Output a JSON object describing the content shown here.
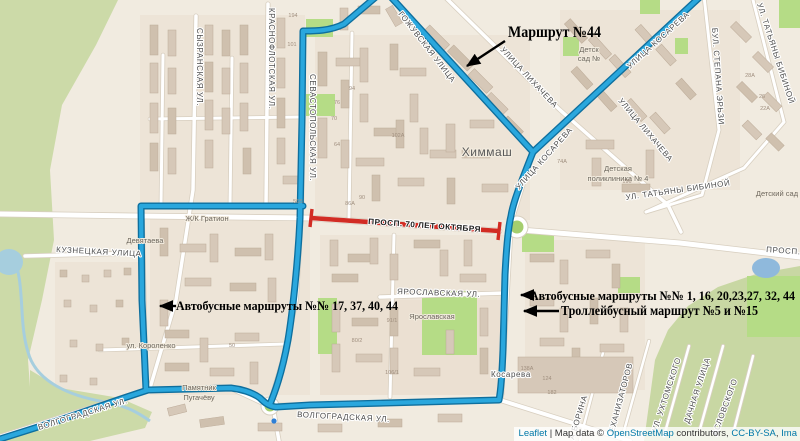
{
  "annotations": {
    "route44": "Маршрут №44",
    "left_bus": "Автобусные маршруты №№ 17, 37, 40, 44",
    "right_bus": "Автобусные маршруты №№ 1, 16, 20,23,27, 32, 44",
    "trolleybus": "Троллейбусный маршрут №5 и №15"
  },
  "closed_road": {
    "label": "ПРОСП. 70 ЛЕТ ОКТЯБРЯ"
  },
  "attribution": {
    "leaflet": "Leaflet",
    "sep1": " | Map data © ",
    "osm": "OpenStreetMap",
    "sep2": " contributors, ",
    "license": "CC-BY-SA",
    "sep3": ", ",
    "imagery": "Ima"
  },
  "map": {
    "street_labels": [
      {
        "t": "СЫЗРАНСКАЯ УЛ.",
        "x": 197,
        "y": 28,
        "r": 90
      },
      {
        "t": "КРАСНОФЛОТСКАЯ УЛ.",
        "x": 269,
        "y": 8,
        "r": 90
      },
      {
        "t": "СЕВАСТОПОЛЬСКАЯ УЛ.",
        "x": 310,
        "y": 74,
        "r": 90
      },
      {
        "t": "ГОЖУВСКАЯ УЛИЦА",
        "x": 398,
        "y": 14,
        "r": 52
      },
      {
        "t": "УЛИЦА ЛИХАЧЕВА",
        "x": 500,
        "y": 50,
        "r": 47
      },
      {
        "t": "УЛИЦА ЛИХАЧЕВА",
        "x": 618,
        "y": 101,
        "r": 50
      },
      {
        "t": "УЛИЦА КОСАРЕВА",
        "x": 630,
        "y": 69,
        "r": -42
      },
      {
        "t": "УЛИЦА КОСАРЕВА",
        "x": 519,
        "y": 190,
        "r": -48
      },
      {
        "t": "УЛ. ТАТЬЯНЫ БИБИНОЙ",
        "x": 757,
        "y": 4,
        "r": 72
      },
      {
        "t": "БУЛ. СТЕПАНА ЭРЬЗИ",
        "x": 712,
        "y": 28,
        "r": 86
      },
      {
        "t": "УЛ. ТАТЬЯНЫ БИБИНОЙ",
        "x": 626,
        "y": 200,
        "r": -8
      },
      {
        "t": "КУЗНЕЦКАЯ УЛИЦА",
        "x": 56,
        "y": 252,
        "r": 3
      },
      {
        "t": "ЯРОСЛАВСКАЯ УЛ.",
        "x": 397,
        "y": 294,
        "r": 2
      },
      {
        "t": "ВОЛГОГРАДСКАЯ УЛ.",
        "x": 39,
        "y": 430,
        "r": -17
      },
      {
        "t": "ВОЛГОГРАДСКАЯ УЛ.",
        "x": 297,
        "y": 417,
        "r": 3
      },
      {
        "t": "ПРОСП. 7",
        "x": 766,
        "y": 252,
        "r": 4
      },
      {
        "t": "Косарева",
        "x": 491,
        "y": 377,
        "r": 0
      },
      {
        "t": "А БОРИНА",
        "x": 574,
        "y": 440,
        "r": -73
      },
      {
        "t": "ЕХАНИЗАТОРОВ",
        "x": 614,
        "y": 433,
        "r": -75
      },
      {
        "t": "УЛ. УХТОМСКОГО",
        "x": 657,
        "y": 432,
        "r": -72
      },
      {
        "t": "ДАЧНАЯ УЛИЦА",
        "x": 689,
        "y": 424,
        "r": -72
      },
      {
        "t": "АСЛОВСКОГО",
        "x": 717,
        "y": 436,
        "r": -70
      }
    ],
    "place_labels": [
      {
        "t": "Химмаш",
        "x": 487,
        "y": 156,
        "a": "middle",
        "c": "big"
      },
      {
        "t": "Детская",
        "x": 618,
        "y": 171,
        "a": "middle"
      },
      {
        "t": "поликлиника № 4",
        "x": 618,
        "y": 181,
        "a": "middle"
      },
      {
        "t": "Детск",
        "x": 589,
        "y": 52,
        "a": "middle"
      },
      {
        "t": "сад №",
        "x": 589,
        "y": 61,
        "a": "middle"
      },
      {
        "t": "Детский сад",
        "x": 777,
        "y": 196,
        "a": "middle"
      },
      {
        "t": "Ж/К Гратион",
        "x": 207,
        "y": 221,
        "a": "middle"
      },
      {
        "t": "Девятаева",
        "x": 145,
        "y": 243,
        "a": "middle"
      },
      {
        "t": "ул. Короленко",
        "x": 151,
        "y": 348,
        "a": "middle"
      },
      {
        "t": "Памятник",
        "x": 199,
        "y": 390,
        "a": "middle"
      },
      {
        "t": "Пугачёву",
        "x": 199,
        "y": 400,
        "a": "middle"
      },
      {
        "t": "Ярославская",
        "x": 432,
        "y": 319,
        "a": "middle"
      }
    ],
    "house_numbers": [
      {
        "t": "194",
        "x": 293,
        "y": 17
      },
      {
        "t": "101",
        "x": 292,
        "y": 46
      },
      {
        "t": "94",
        "x": 352,
        "y": 90
      },
      {
        "t": "76",
        "x": 337,
        "y": 104
      },
      {
        "t": "70",
        "x": 334,
        "y": 120
      },
      {
        "t": "64",
        "x": 337,
        "y": 146
      },
      {
        "t": "102А",
        "x": 398,
        "y": 137
      },
      {
        "t": "86А",
        "x": 350,
        "y": 205
      },
      {
        "t": "56Б",
        "x": 298,
        "y": 203
      },
      {
        "t": "90",
        "x": 362,
        "y": 199
      },
      {
        "t": "74А",
        "x": 562,
        "y": 163
      },
      {
        "t": "196",
        "x": 627,
        "y": 183
      },
      {
        "t": "28А",
        "x": 750,
        "y": 77
      },
      {
        "t": "26",
        "x": 762,
        "y": 98
      },
      {
        "t": "22А",
        "x": 765,
        "y": 110
      },
      {
        "t": "91/1",
        "x": 392,
        "y": 322
      },
      {
        "t": "80/2",
        "x": 357,
        "y": 342
      },
      {
        "t": "106/1",
        "x": 392,
        "y": 374
      },
      {
        "t": "138А",
        "x": 527,
        "y": 370
      },
      {
        "t": "124",
        "x": 547,
        "y": 380
      },
      {
        "t": "182",
        "x": 552,
        "y": 394
      },
      {
        "t": "50",
        "x": 232,
        "y": 347
      }
    ],
    "colors": {
      "route_blue": "#2aa7dd",
      "route_casing": "#0e6f9e",
      "closed_red": "#d22c24",
      "link": "#0078a8",
      "water": "#a6cede",
      "park": "#b5dc86",
      "forest": "#ccdaa8",
      "building": "#d6c8b8"
    }
  }
}
